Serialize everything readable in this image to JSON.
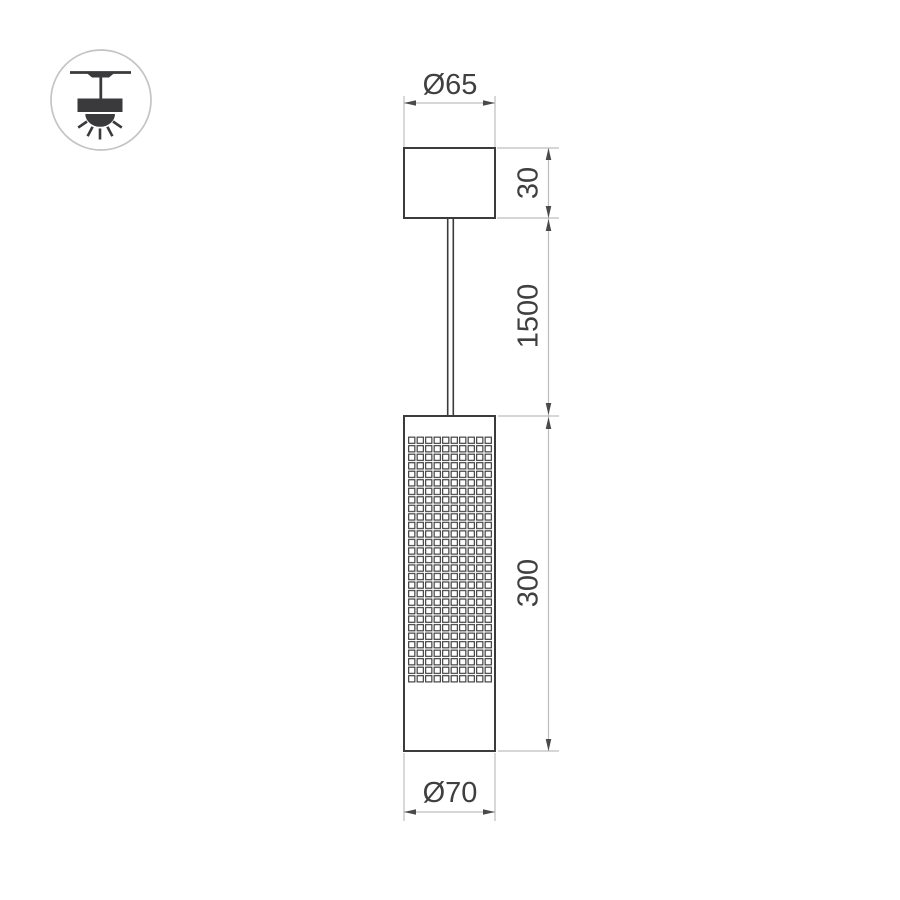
{
  "icon": {
    "name": "pendant-lamp-ceiling-mount-icon"
  },
  "dims": {
    "canopy_diameter": "Ø65",
    "canopy_height": "30",
    "suspension_length": "1500",
    "body_height": "300",
    "body_diameter": "Ø70"
  },
  "colors": {
    "background": "#ffffff",
    "object_line": "#3b3b3c",
    "dimension_line": "#bdbdbd",
    "arrow": "#4a4a4a",
    "text": "#3f3f3f",
    "icon_fill": "#3a3a3c",
    "icon_circle_stroke": "#c4c4c4"
  }
}
